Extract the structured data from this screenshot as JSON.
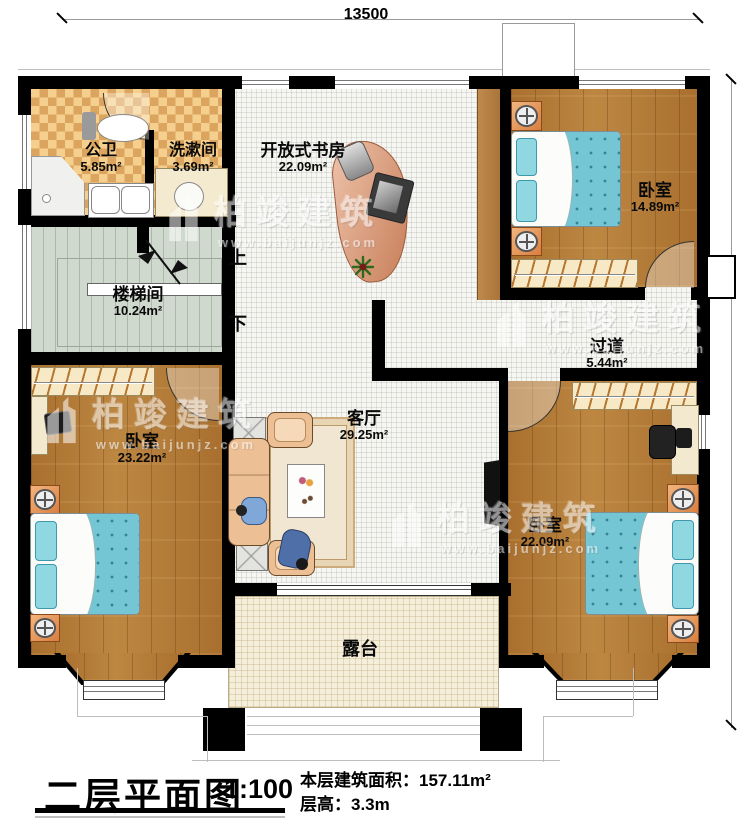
{
  "dimensions": {
    "width_mm": "13500",
    "height_mm": "12800"
  },
  "rooms": [
    {
      "name": "公卫",
      "area": "5.85m²"
    },
    {
      "name": "洗漱间",
      "area": "3.69m²"
    },
    {
      "name": "开放式书房",
      "area": "22.09m²"
    },
    {
      "name": "卧室",
      "area": "14.89m²"
    },
    {
      "name": "楼梯间",
      "area": "10.24m²"
    },
    {
      "name": "过道",
      "area": "5.44m²"
    },
    {
      "name": "卧室",
      "area": "23.22m²"
    },
    {
      "name": "客厅",
      "area": "29.25m²"
    },
    {
      "name": "卧室",
      "area": "22.09m²"
    },
    {
      "name": "露台",
      "area": ""
    }
  ],
  "stairs": {
    "up_label": "上",
    "down_label": "下"
  },
  "watermark": {
    "brand": "柏竣建筑",
    "url": "www.baijunjz.com"
  },
  "titleblock": {
    "title": "二层平面图",
    "scale": "1:100",
    "area_label": "本层建筑面积：",
    "area_value": "157.11m²",
    "floor_height_label": "层高：",
    "floor_height_value": "3.3m"
  },
  "colors": {
    "wall": "#000000",
    "wood_floor": "#b07a36",
    "tile_light": "#f5cf8e",
    "tile_dark": "#dca55f",
    "stair_floor": "#cfd9cd",
    "open_floor": "#f6f6f3",
    "terrace_floor": "#f4eedb",
    "bed": "#74c6d4",
    "sofa": "#edbf94"
  }
}
